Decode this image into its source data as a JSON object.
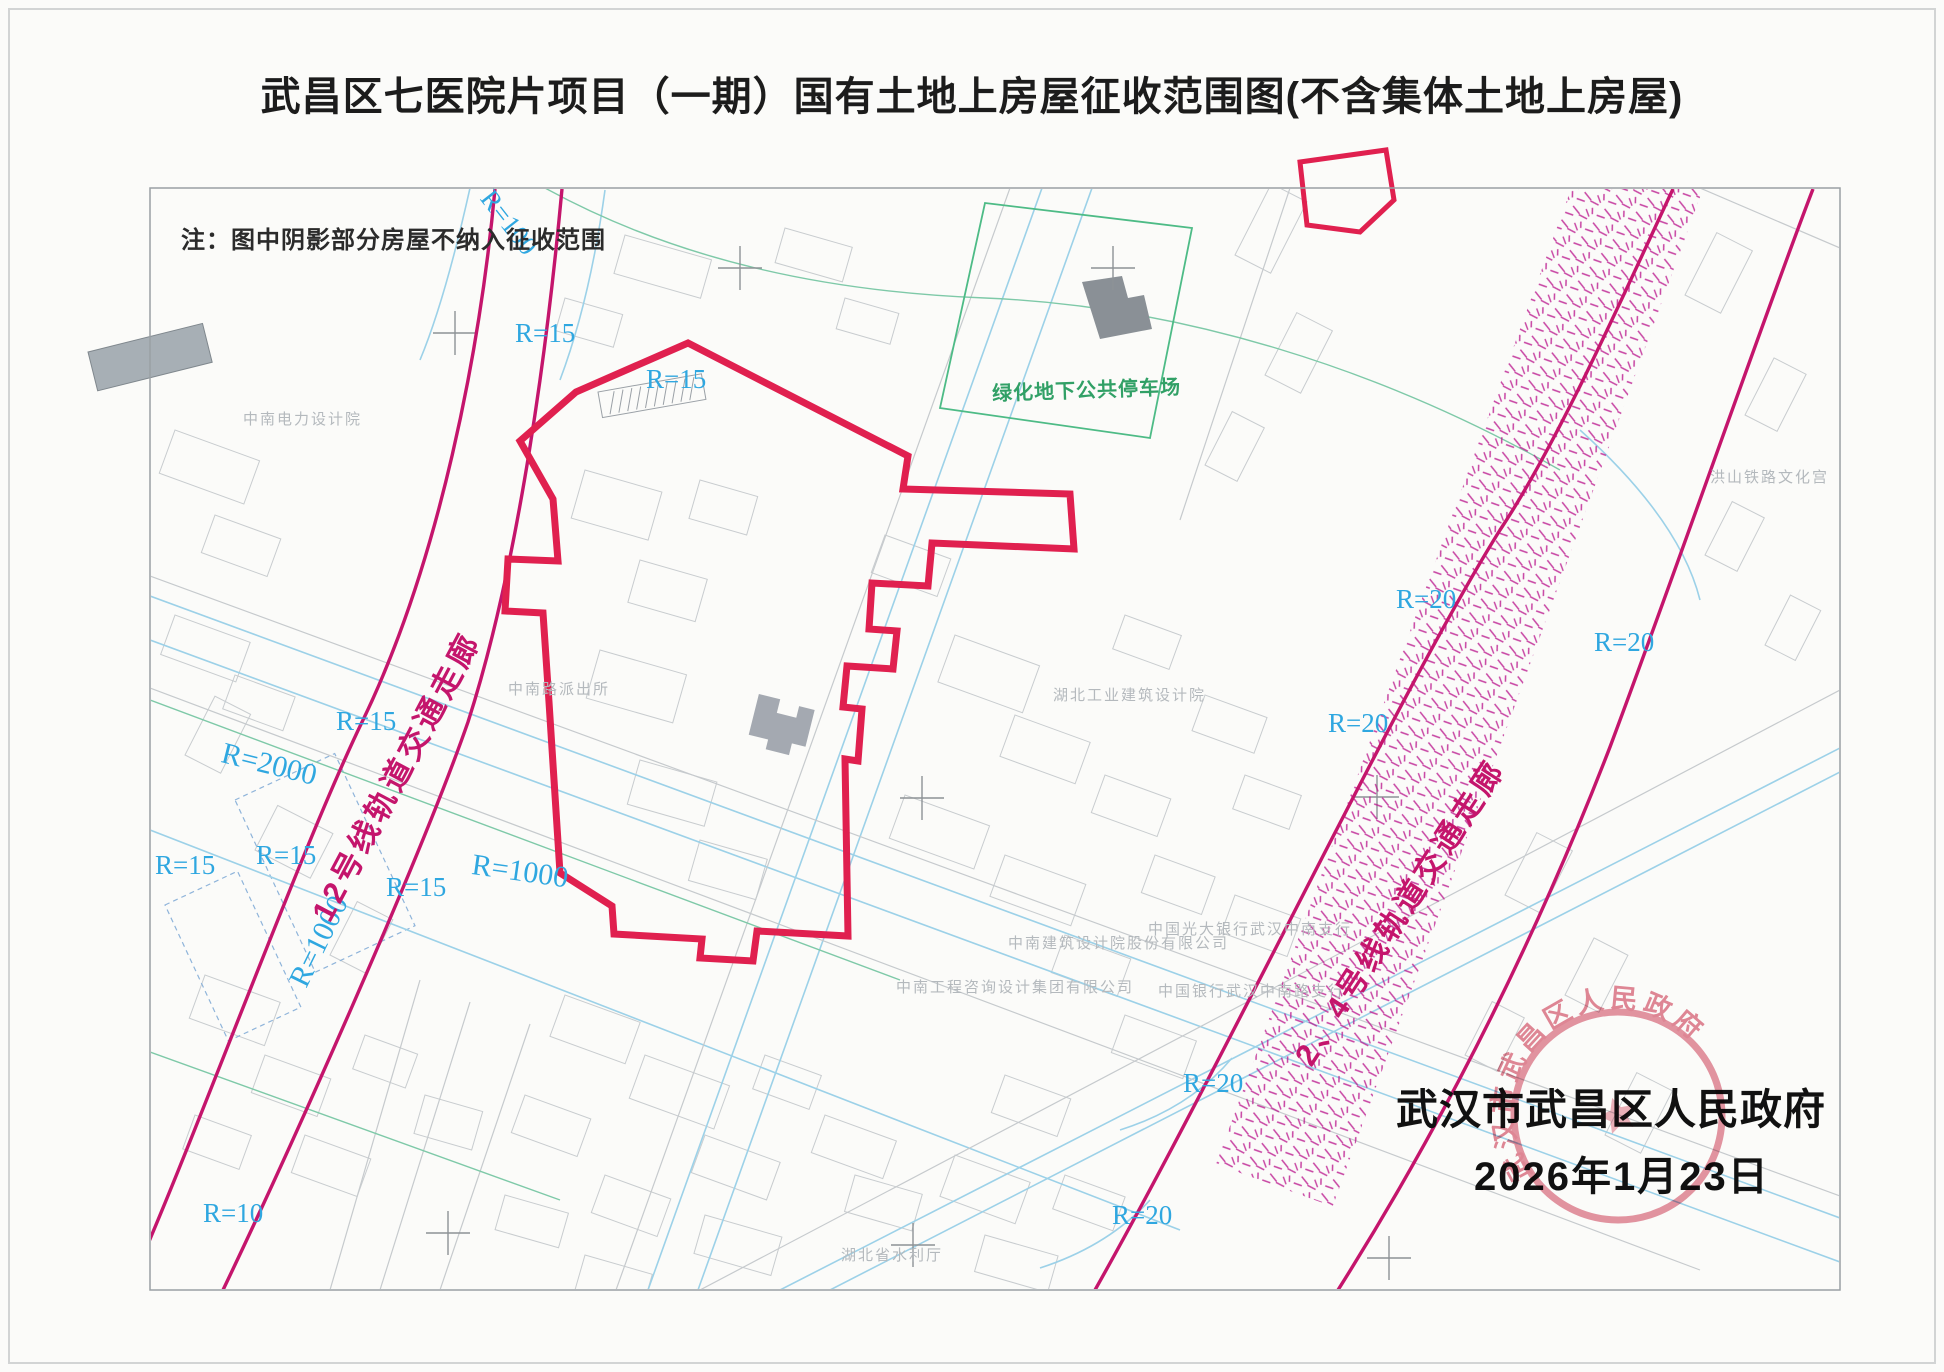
{
  "title": "武昌区七医院片项目（一期）国有土地上房屋征收范围图(不含集体土地上房屋)",
  "note": "注：图中阴影部分房屋不纳入征收范围",
  "map": {
    "parking_label": "绿化地下公共停车场",
    "corridor_labels": {
      "line12": "12号线轨道交通走廊",
      "line24": "2、4号线轨道交通走廊"
    },
    "radius_labels": {
      "r100": "R=100",
      "r15": "R=15",
      "r2000": "R=2000",
      "r1000": "R=1000",
      "r10": "R=10",
      "r20": "R=20"
    },
    "place_labels": {
      "power_design": "中南电力设计院",
      "police_station": "中南路派出所",
      "hubei_industrial_design": "湖北工业建筑设计院",
      "zhongnan_architecture": "中南建筑设计院股份有限公司",
      "zhongnan_engineering": "中南工程咨询设计集团有限公司",
      "everbright_bank": "中国光大银行武汉中南支行",
      "bank_of_china": "中国银行武汉中南路支行",
      "water_department": "湖北省水利厅",
      "railway_culture_palace": "洪山铁路文化宫"
    }
  },
  "footer": {
    "authority": "武汉市武昌区人民政府",
    "date": "2026年1月23日"
  },
  "seal": {
    "text": "武汉市武昌区人民政府"
  },
  "colors": {
    "boundary_red": "#e0204f",
    "corridor_magenta": "#c4156c",
    "radius_blue": "#2fa7e0",
    "parking_green": "#31a066",
    "seal_red": "#dd7386"
  }
}
